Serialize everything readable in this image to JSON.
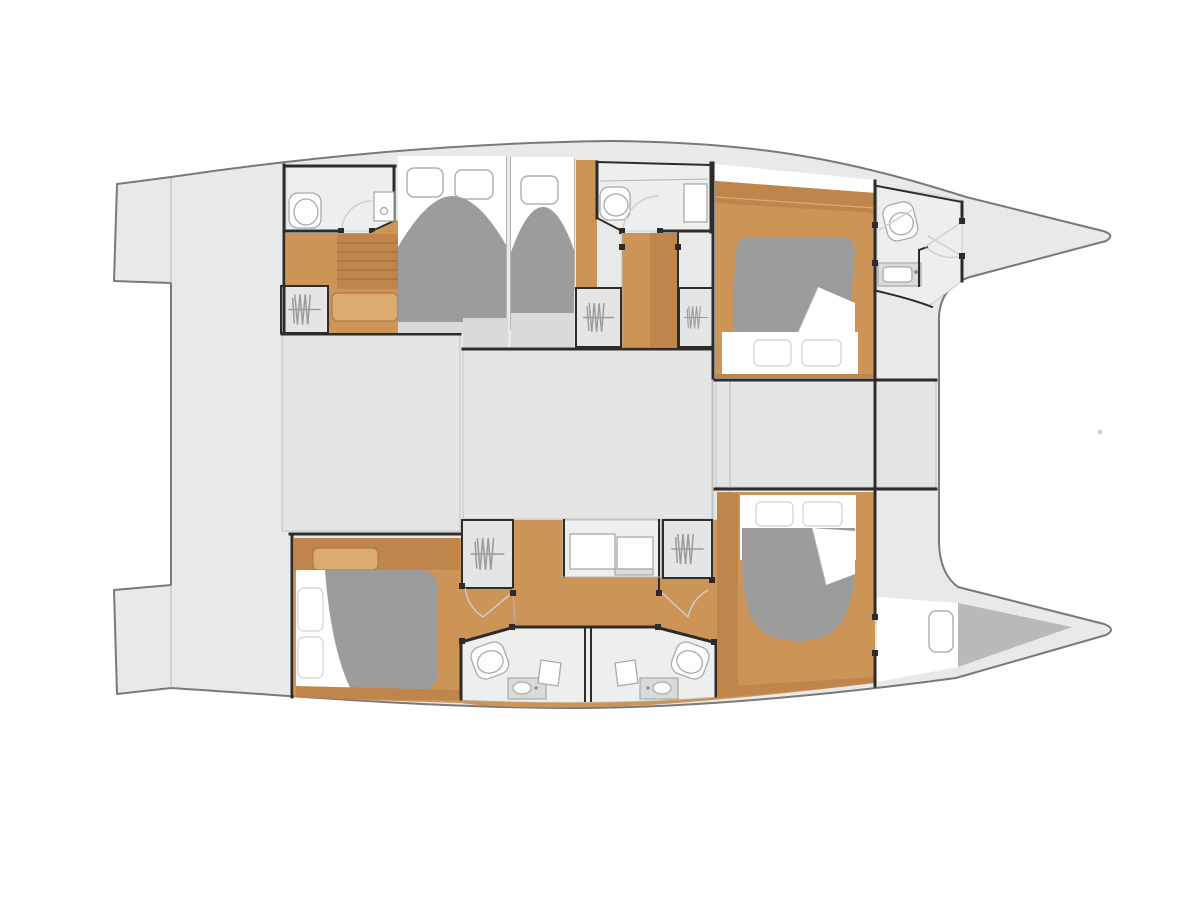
{
  "meta": {
    "label": "Catamaran yacht interior layout floor plan, top view, bow to the right",
    "view": "top-down deck plan",
    "visible_text": []
  },
  "colors": {
    "hull": "#e8eae9",
    "block": "#e4e6e5",
    "bath": "#edefee",
    "wood_dark": "#c0854a",
    "wood_mid": "#cd9458",
    "wood_light": "#dcab72",
    "duvet": "#9b9c9b",
    "forepeak": "#b9bab8",
    "wall": "#2e2c29",
    "outline": "#77797a",
    "blockline": "#c2c4c3",
    "thinline": "#b5b7b6",
    "winline": "#b0b2b1",
    "pilline": "#d0d2d1",
    "fixline": "#a9abaa",
    "arc": "#cfcfcc",
    "step": "#d9dbda"
  },
  "rooms": [
    {
      "id": "aft-deck",
      "name": "aft cockpit and twin transom swim platforms"
    },
    {
      "id": "salon-block-aft",
      "name": "bridgedeck saloon block (aft)"
    },
    {
      "id": "salon-block-fwd",
      "name": "bridgedeck saloon block (forward)"
    },
    {
      "id": "forward-cockpit",
      "name": "forward cockpit block"
    },
    {
      "id": "port-bathroom-aft",
      "name": "port aft bathroom with toilet and shower"
    },
    {
      "id": "port-cabin-1",
      "name": "port double cabin with two hull windows"
    },
    {
      "id": "port-cabin-2",
      "name": "port single cabin with hull window"
    },
    {
      "id": "port-bathroom-mid",
      "name": "port mid bathroom with toilet and shower"
    },
    {
      "id": "starboard-fwd-cabin",
      "name": "forward double cabin, head outboard"
    },
    {
      "id": "bow-bathroom",
      "name": "forward bow bathroom with toilet and vanity"
    },
    {
      "id": "aft-cabin-left",
      "name": "aft double cabin, pillows inboard"
    },
    {
      "id": "twin-bathrooms",
      "name": "back-to-back twin bathrooms with two toilets and two vanities"
    },
    {
      "id": "fwd-cabin-right",
      "name": "lower forward double cabin"
    },
    {
      "id": "forepeak",
      "name": "bow storage forepeak"
    }
  ],
  "fixtures": {
    "beds": 5,
    "pillows": 6,
    "toilets": 5,
    "vanity_sinks": 3,
    "showers": 2,
    "wardrobes": 5,
    "stair_flights": 2,
    "hull_windows": 4,
    "door_posts": "multiple black jamb markers",
    "door_swings": "faint quarter-circle arcs"
  }
}
